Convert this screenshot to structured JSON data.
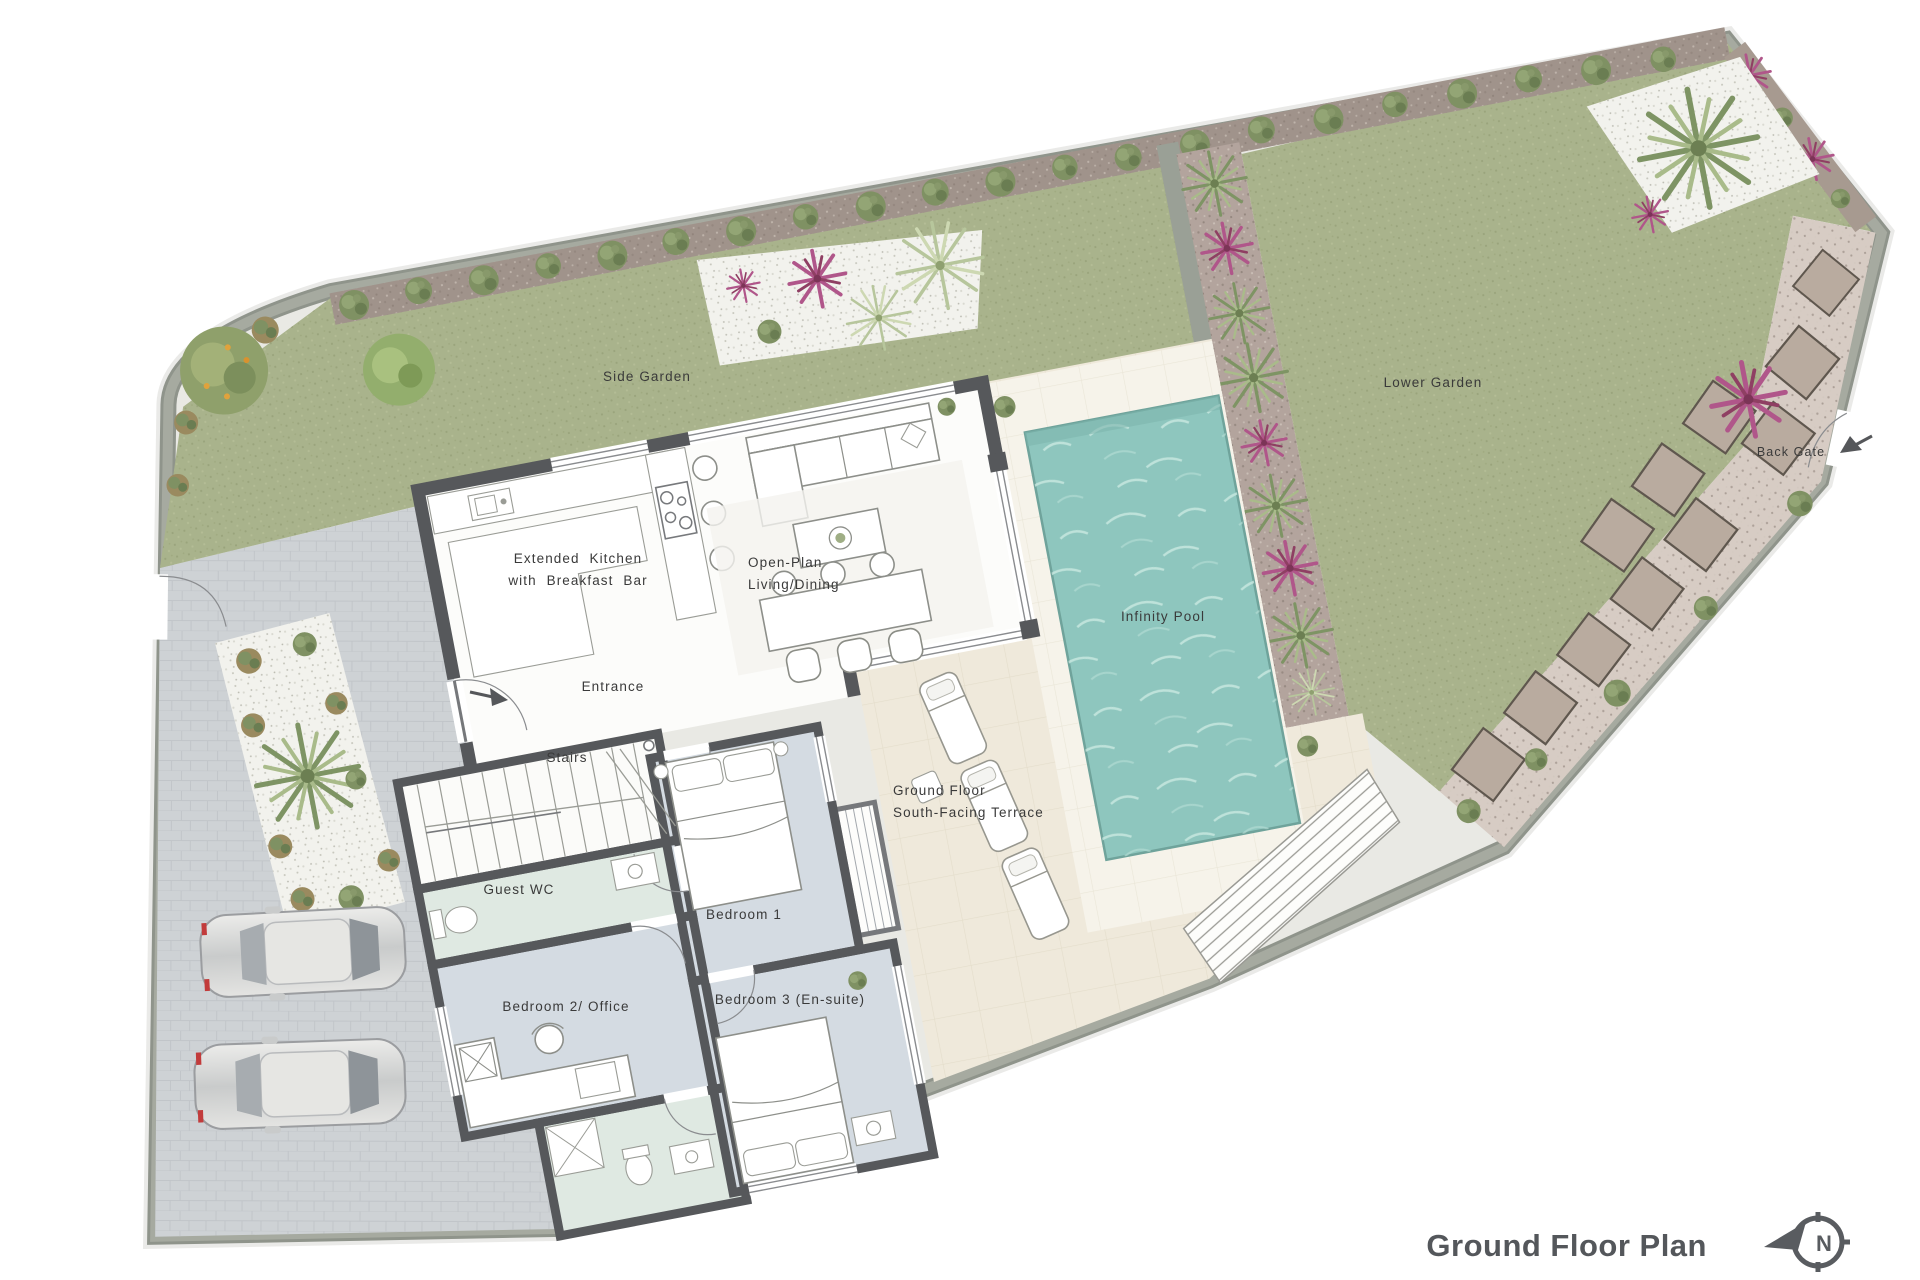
{
  "plan": {
    "title": "Ground Floor Plan",
    "compass_letter": "N",
    "labels": {
      "side_garden": "Side Garden",
      "lower_garden": "Lower Garden",
      "back_gate": "Back Gate",
      "kitchen_line1": "Extended Kitchen",
      "kitchen_line2": "with Breakfast Bar",
      "living_line1": "Open-Plan",
      "living_line2": "Living/Dining",
      "infinity_pool": "Infinity Pool",
      "entrance": "Entrance",
      "stairs": "Stairs",
      "terrace_line1": "Ground Floor",
      "terrace_line2": "South-Facing Terrace",
      "guest_wc": "Guest WC",
      "bedroom1": "Bedroom 1",
      "bedroom2": "Bedroom 2/ Office",
      "bedroom3": "Bedroom 3 (En-suite)"
    },
    "colors": {
      "lawn": "#a9b38c",
      "hedge_band": "#a0938b",
      "boundary_wall": "#a6aaa0",
      "white_gravel": "#f2f2ed",
      "planted_strip": "#b3a49d",
      "gravel_path": "#d7ccc4",
      "stepping_stone": "#b9ab9f",
      "pool_water": "#8ec6be",
      "pool_surround": "#f6f3ea",
      "terrace": "#efe9db",
      "driveway": "#ced2d5",
      "house_wall": "#56585b",
      "room_white": "#fcfcfa",
      "bedroom_floor": "#d4dbe2",
      "bath_floor": "#dfe9e2",
      "label_text": "#3a3a3a",
      "title_text": "#54575b"
    }
  }
}
